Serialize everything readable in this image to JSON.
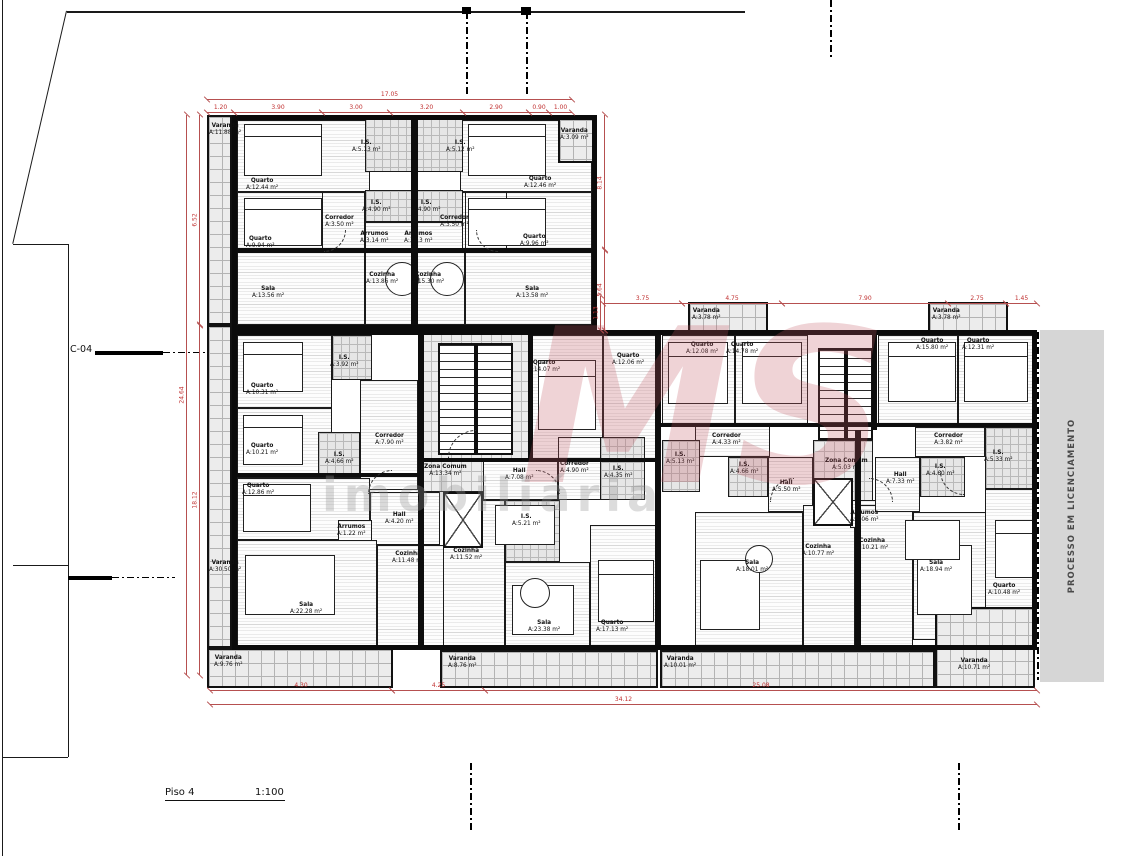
{
  "title": {
    "floor_label": "Piso 4",
    "scale_label": "1:100"
  },
  "side_note": {
    "text": "PROCESSO EM LICENCIAMENTO"
  },
  "section_marker": {
    "label": "C-04"
  },
  "watermark": {
    "logo": "MS",
    "word": "imobiliária"
  },
  "colors": {
    "dimension_line": "#b65050",
    "dimension_text": "#c03030",
    "wall": "#0d0d0d",
    "balcony_bg": "#ececec",
    "band_bg": "#d6d6d6",
    "watermark_logo": "rgba(193,85,95,0.26)"
  },
  "outlines": [
    {
      "x": 232,
      "y": 115,
      "w": 365,
      "h": 215
    },
    {
      "x": 232,
      "y": 330,
      "w": 805,
      "h": 320
    }
  ],
  "rooms": [
    {
      "n": "Varanda",
      "a": "A:11.88 m²",
      "x": 207,
      "y": 115,
      "w": 25,
      "h": 210,
      "t": "balcony",
      "lx": 209,
      "ly": 123
    },
    {
      "n": "Varanda",
      "a": "A:30.50 m²",
      "x": 207,
      "y": 325,
      "w": 25,
      "h": 323,
      "t": "balcony",
      "lx": 209,
      "ly": 560
    },
    {
      "n": "Varanda",
      "a": "A:9.76 m²",
      "x": 207,
      "y": 648,
      "w": 186,
      "h": 40,
      "t": "balcony",
      "lx": 214,
      "ly": 655
    },
    {
      "n": "Quarto",
      "a": "A:12.44 m²",
      "x": 237,
      "y": 120,
      "w": 133,
      "h": 72,
      "t": "room",
      "lx": 246,
      "ly": 178
    },
    {
      "n": "Quarto",
      "a": "A:9.94 m²",
      "x": 237,
      "y": 192,
      "w": 133,
      "h": 60,
      "t": "room",
      "lx": 246,
      "ly": 236
    },
    {
      "n": "Sala",
      "a": "A:13.56 m²",
      "x": 237,
      "y": 252,
      "w": 128,
      "h": 73,
      "t": "room",
      "lx": 252,
      "ly": 286
    },
    {
      "n": "Cozinha",
      "a": "A:13.86 m²",
      "x": 365,
      "y": 252,
      "w": 49,
      "h": 73,
      "t": "room",
      "lx": 366,
      "ly": 272
    },
    {
      "n": "I.S.",
      "a": "A:5.13 m²",
      "x": 365,
      "y": 118,
      "w": 49,
      "h": 54,
      "t": "bath",
      "lx": 352,
      "ly": 140
    },
    {
      "n": "I.S.",
      "a": "A:4.90 m²",
      "x": 365,
      "y": 190,
      "w": 49,
      "h": 32,
      "t": "bath",
      "lx": 362,
      "ly": 200
    },
    {
      "n": "Arrumos",
      "a": "A:3.14 m²",
      "x": 365,
      "y": 222,
      "w": 49,
      "h": 30,
      "t": "room",
      "lx": 360,
      "ly": 231
    },
    {
      "n": "Corredor",
      "a": "A:3.50 m²",
      "x": 322,
      "y": 192,
      "w": 43,
      "h": 60,
      "t": "room",
      "lx": 325,
      "ly": 215
    },
    {
      "n": "Quarto",
      "a": "A:12.46 m²",
      "x": 460,
      "y": 120,
      "w": 132,
      "h": 72,
      "t": "room",
      "lx": 524,
      "ly": 176
    },
    {
      "n": "Quarto",
      "a": "A:9.96 m²",
      "x": 460,
      "y": 192,
      "w": 132,
      "h": 60,
      "t": "room",
      "lx": 520,
      "ly": 234
    },
    {
      "n": "Sala",
      "a": "A:13.58 m²",
      "x": 465,
      "y": 252,
      "w": 127,
      "h": 73,
      "t": "room",
      "lx": 516,
      "ly": 286
    },
    {
      "n": "Cozinha",
      "a": "A:15.30 m²",
      "x": 414,
      "y": 252,
      "w": 51,
      "h": 73,
      "t": "room",
      "lx": 412,
      "ly": 272
    },
    {
      "n": "I.S.",
      "a": "A:5.12 m²",
      "x": 414,
      "y": 118,
      "w": 49,
      "h": 54,
      "t": "bath",
      "lx": 446,
      "ly": 140
    },
    {
      "n": "I.S.",
      "a": "A:4.90 m²",
      "x": 414,
      "y": 190,
      "w": 49,
      "h": 32,
      "t": "bath",
      "lx": 412,
      "ly": 200
    },
    {
      "n": "Arrumos",
      "a": "A:3.13 m²",
      "x": 414,
      "y": 222,
      "w": 49,
      "h": 30,
      "t": "room",
      "lx": 404,
      "ly": 231
    },
    {
      "n": "Corredor",
      "a": "A:3.50 m²",
      "x": 465,
      "y": 192,
      "w": 42,
      "h": 60,
      "t": "room",
      "lx": 440,
      "ly": 215
    },
    {
      "n": "Varanda",
      "a": "A:3.09 m²",
      "x": 558,
      "y": 118,
      "w": 37,
      "h": 45,
      "t": "balcony",
      "lx": 560,
      "ly": 128
    },
    {
      "n": "Quarto",
      "a": "A:10.31 m²",
      "x": 237,
      "y": 335,
      "w": 95,
      "h": 73,
      "t": "room",
      "lx": 246,
      "ly": 383
    },
    {
      "n": "Quarto",
      "a": "A:10.21 m²",
      "x": 237,
      "y": 408,
      "w": 95,
      "h": 70,
      "t": "room",
      "lx": 246,
      "ly": 443
    },
    {
      "n": "I.S.",
      "a": "A:3.92 m²",
      "x": 332,
      "y": 335,
      "w": 40,
      "h": 45,
      "t": "bath",
      "lx": 330,
      "ly": 355
    },
    {
      "n": "I.S.",
      "a": "A:4.66 m²",
      "x": 318,
      "y": 432,
      "w": 42,
      "h": 46,
      "t": "bath",
      "lx": 325,
      "ly": 452
    },
    {
      "n": "Corredor",
      "a": "A:7.90 m²",
      "x": 360,
      "y": 380,
      "w": 58,
      "h": 110,
      "t": "room",
      "lx": 375,
      "ly": 433
    },
    {
      "n": "Quarto",
      "a": "A:12.86 m²",
      "x": 237,
      "y": 478,
      "w": 133,
      "h": 62,
      "t": "room",
      "lx": 242,
      "ly": 483
    },
    {
      "n": "Hall",
      "a": "A:4.20 m²",
      "x": 370,
      "y": 492,
      "w": 70,
      "h": 53,
      "t": "room",
      "lx": 385,
      "ly": 512
    },
    {
      "n": "Arrumos",
      "a": "A:1.22 m²",
      "x": 338,
      "y": 520,
      "w": 34,
      "h": 25,
      "t": "room",
      "lx": 337,
      "ly": 524
    },
    {
      "n": "Sala",
      "a": "A:22.28 m²",
      "x": 237,
      "y": 540,
      "w": 140,
      "h": 110,
      "t": "room",
      "lx": 290,
      "ly": 602
    },
    {
      "n": "Cozinha",
      "a": "A:11.48 m²",
      "x": 377,
      "y": 545,
      "w": 68,
      "h": 105,
      "t": "room",
      "lx": 392,
      "ly": 551
    },
    {
      "n": "Zona Comum",
      "a": "A:13.34 m²",
      "x": 420,
      "y": 330,
      "w": 110,
      "h": 162,
      "t": "core",
      "lx": 424,
      "ly": 464
    },
    {
      "n": "Quarto",
      "a": "A:14.07 m²",
      "x": 530,
      "y": 335,
      "w": 73,
      "h": 125,
      "t": "room",
      "lx": 528,
      "ly": 360
    },
    {
      "n": "Quarto",
      "a": "A:12.06 m²",
      "x": 603,
      "y": 335,
      "w": 55,
      "h": 125,
      "t": "room",
      "lx": 612,
      "ly": 353
    },
    {
      "n": "Hall",
      "a": "A:7.08 m²",
      "x": 483,
      "y": 460,
      "w": 75,
      "h": 40,
      "t": "room",
      "lx": 505,
      "ly": 468
    },
    {
      "n": "Corredor",
      "a": "A:4.90 m²",
      "x": 558,
      "y": 437,
      "w": 45,
      "h": 63,
      "t": "room",
      "lx": 560,
      "ly": 461
    },
    {
      "n": "I.S.",
      "a": "A:4.35 m²",
      "x": 600,
      "y": 437,
      "w": 45,
      "h": 63,
      "t": "bath",
      "lx": 604,
      "ly": 466
    },
    {
      "n": "I.S.",
      "a": "A:5.21 m²",
      "x": 505,
      "y": 500,
      "w": 55,
      "h": 62,
      "t": "bath",
      "lx": 512,
      "ly": 514
    },
    {
      "n": "Cozinha",
      "a": "A:11.52 m²",
      "x": 443,
      "y": 500,
      "w": 62,
      "h": 150,
      "t": "room",
      "lx": 450,
      "ly": 548
    },
    {
      "n": "Sala",
      "a": "A:23.38 m²",
      "x": 505,
      "y": 562,
      "w": 85,
      "h": 88,
      "t": "room",
      "lx": 528,
      "ly": 620
    },
    {
      "n": "Quarto",
      "a": "A:17.13 m²",
      "x": 590,
      "y": 525,
      "w": 68,
      "h": 125,
      "t": "room",
      "lx": 596,
      "ly": 620
    },
    {
      "n": "Quarto",
      "a": "A:12.08 m²",
      "x": 662,
      "y": 335,
      "w": 73,
      "h": 90,
      "t": "room",
      "lx": 686,
      "ly": 342
    },
    {
      "n": "Quarto",
      "a": "A:14.78 m²",
      "x": 735,
      "y": 335,
      "w": 73,
      "h": 90,
      "t": "room",
      "lx": 726,
      "ly": 342
    },
    {
      "n": "Corredor",
      "a": "A:4.33 m²",
      "x": 695,
      "y": 425,
      "w": 75,
      "h": 32,
      "t": "room",
      "lx": 712,
      "ly": 433
    },
    {
      "n": "I.S.",
      "a": "A:5.13 m²",
      "x": 662,
      "y": 440,
      "w": 38,
      "h": 52,
      "t": "bath",
      "lx": 666,
      "ly": 452
    },
    {
      "n": "I.S.",
      "a": "A:4.66 m²",
      "x": 728,
      "y": 457,
      "w": 40,
      "h": 40,
      "t": "bath",
      "lx": 730,
      "ly": 462
    },
    {
      "n": "Hall",
      "a": "A:5.50 m²",
      "x": 768,
      "y": 457,
      "w": 45,
      "h": 55,
      "t": "room",
      "lx": 772,
      "ly": 480
    },
    {
      "n": "Sala",
      "a": "A:18.01 m²",
      "x": 695,
      "y": 512,
      "w": 108,
      "h": 138,
      "t": "room",
      "lx": 736,
      "ly": 560
    },
    {
      "n": "Cozinha",
      "a": "A:10.77 m²",
      "x": 803,
      "y": 505,
      "w": 52,
      "h": 145,
      "t": "room",
      "lx": 802,
      "ly": 544
    },
    {
      "n": "Zona Comum",
      "a": "A:5.03 m²",
      "x": 813,
      "y": 440,
      "w": 60,
      "h": 65,
      "t": "core",
      "lx": 825,
      "ly": 458
    },
    {
      "n": "Arrumos",
      "a": "A:1.06 m²",
      "x": 850,
      "y": 500,
      "w": 32,
      "h": 28,
      "t": "room",
      "lx": 850,
      "ly": 510
    },
    {
      "n": "Cozinha",
      "a": "A:10.21 m²",
      "x": 858,
      "y": 505,
      "w": 55,
      "h": 145,
      "t": "room",
      "lx": 856,
      "ly": 538
    },
    {
      "n": "Quarto",
      "a": "A:15.80 m²",
      "x": 878,
      "y": 335,
      "w": 80,
      "h": 92,
      "t": "room",
      "lx": 916,
      "ly": 338
    },
    {
      "n": "Quarto",
      "a": "A:12.31 m²",
      "x": 958,
      "y": 335,
      "w": 77,
      "h": 92,
      "t": "room",
      "lx": 962,
      "ly": 338
    },
    {
      "n": "Corredor",
      "a": "A:3.82 m²",
      "x": 915,
      "y": 427,
      "w": 70,
      "h": 30,
      "t": "room",
      "lx": 934,
      "ly": 433
    },
    {
      "n": "I.S.",
      "a": "A:5.33 m²",
      "x": 985,
      "y": 427,
      "w": 50,
      "h": 62,
      "t": "bath",
      "lx": 984,
      "ly": 450
    },
    {
      "n": "I.S.",
      "a": "A:4.60 m²",
      "x": 920,
      "y": 457,
      "w": 45,
      "h": 40,
      "t": "bath",
      "lx": 926,
      "ly": 464
    },
    {
      "n": "Hall",
      "a": "A:7.33 m²",
      "x": 875,
      "y": 457,
      "w": 45,
      "h": 55,
      "t": "room",
      "lx": 886,
      "ly": 472
    },
    {
      "n": "Sala",
      "a": "A:18.94 m²",
      "x": 913,
      "y": 512,
      "w": 92,
      "h": 128,
      "t": "room",
      "lx": 920,
      "ly": 560
    },
    {
      "n": "Quarto",
      "a": "A:10.48 m²",
      "x": 985,
      "y": 489,
      "w": 50,
      "h": 125,
      "t": "room",
      "lx": 988,
      "ly": 583
    },
    {
      "n": "Varanda",
      "a": "A:3.78 m²",
      "x": 688,
      "y": 302,
      "w": 80,
      "h": 32,
      "t": "balcony",
      "lx": 692,
      "ly": 308
    },
    {
      "n": "Varanda",
      "a": "A:3.78 m²",
      "x": 928,
      "y": 302,
      "w": 80,
      "h": 32,
      "t": "balcony",
      "lx": 932,
      "ly": 308
    },
    {
      "n": "Varanda",
      "a": "A:8.76 m²",
      "x": 440,
      "y": 650,
      "w": 218,
      "h": 38,
      "t": "balcony",
      "lx": 448,
      "ly": 656
    },
    {
      "n": "Varanda",
      "a": "A:10.01 m²",
      "x": 660,
      "y": 650,
      "w": 275,
      "h": 38,
      "t": "balcony",
      "lx": 664,
      "ly": 656
    },
    {
      "n": "Varanda",
      "a": "A:10.71 m²",
      "x": 935,
      "y": 607,
      "w": 100,
      "h": 81,
      "t": "balcony",
      "lx": 958,
      "ly": 658
    }
  ],
  "walls": [
    {
      "x": 411,
      "y": 115,
      "w": 7,
      "h": 215
    },
    {
      "x": 418,
      "y": 330,
      "w": 6,
      "h": 320
    },
    {
      "x": 655,
      "y": 330,
      "w": 6,
      "h": 320
    },
    {
      "x": 855,
      "y": 430,
      "w": 6,
      "h": 220
    },
    {
      "x": 528,
      "y": 330,
      "w": 5,
      "h": 132
    },
    {
      "x": 232,
      "y": 248,
      "w": 365,
      "h": 5
    },
    {
      "x": 232,
      "y": 473,
      "w": 190,
      "h": 4
    },
    {
      "x": 660,
      "y": 423,
      "w": 377,
      "h": 4
    },
    {
      "x": 872,
      "y": 330,
      "w": 5,
      "h": 100
    },
    {
      "x": 424,
      "y": 458,
      "w": 235,
      "h": 4
    }
  ],
  "stairs": [
    {
      "x": 438,
      "y": 343,
      "w": 75,
      "h": 112
    },
    {
      "x": 818,
      "y": 348,
      "w": 55,
      "h": 92
    }
  ],
  "lifts": [
    {
      "x": 443,
      "y": 492,
      "w": 40,
      "h": 56
    },
    {
      "x": 813,
      "y": 478,
      "w": 40,
      "h": 48
    }
  ],
  "beds": [
    {
      "x": 244,
      "y": 124,
      "w": 78,
      "h": 52
    },
    {
      "x": 244,
      "y": 198,
      "w": 78,
      "h": 48
    },
    {
      "x": 468,
      "y": 124,
      "w": 78,
      "h": 52
    },
    {
      "x": 468,
      "y": 198,
      "w": 78,
      "h": 48
    },
    {
      "x": 243,
      "y": 342,
      "w": 60,
      "h": 50
    },
    {
      "x": 243,
      "y": 415,
      "w": 60,
      "h": 50
    },
    {
      "x": 243,
      "y": 484,
      "w": 68,
      "h": 48
    },
    {
      "x": 538,
      "y": 360,
      "w": 58,
      "h": 70
    },
    {
      "x": 668,
      "y": 342,
      "w": 60,
      "h": 62
    },
    {
      "x": 742,
      "y": 342,
      "w": 60,
      "h": 62
    },
    {
      "x": 888,
      "y": 342,
      "w": 68,
      "h": 60
    },
    {
      "x": 964,
      "y": 342,
      "w": 64,
      "h": 60
    },
    {
      "x": 598,
      "y": 560,
      "w": 56,
      "h": 62
    },
    {
      "x": 995,
      "y": 520,
      "w": 38,
      "h": 58
    }
  ],
  "sofas": [
    {
      "x": 245,
      "y": 555,
      "w": 90,
      "h": 60
    },
    {
      "x": 512,
      "y": 585,
      "w": 62,
      "h": 50
    },
    {
      "x": 700,
      "y": 560,
      "w": 60,
      "h": 70
    },
    {
      "x": 917,
      "y": 545,
      "w": 55,
      "h": 70
    }
  ],
  "rtables": [
    {
      "x": 495,
      "y": 505,
      "w": 60,
      "h": 40
    },
    {
      "x": 905,
      "y": 520,
      "w": 55,
      "h": 40
    }
  ],
  "ctables": [
    {
      "x": 385,
      "y": 262,
      "d": 34
    },
    {
      "x": 430,
      "y": 262,
      "d": 34
    },
    {
      "x": 520,
      "y": 578,
      "d": 30
    },
    {
      "x": 745,
      "y": 545,
      "d": 28
    }
  ],
  "doors": [
    {
      "x": 448,
      "y": 430,
      "s": 28,
      "rot": 0
    },
    {
      "x": 560,
      "y": 470,
      "s": 24,
      "rot": 90
    },
    {
      "x": 770,
      "y": 478,
      "s": 24,
      "rot": 0
    },
    {
      "x": 893,
      "y": 478,
      "s": 24,
      "rot": 90
    },
    {
      "x": 346,
      "y": 252,
      "s": 22,
      "rot": 180
    },
    {
      "x": 476,
      "y": 252,
      "s": 22,
      "rot": 270
    },
    {
      "x": 368,
      "y": 470,
      "s": 24,
      "rot": 0
    },
    {
      "x": 940,
      "y": 495,
      "s": 24,
      "rot": 270
    }
  ],
  "dimensions_h": [
    {
      "x": 207,
      "y": 99,
      "len": 365,
      "label": "17.05"
    },
    {
      "x": 207,
      "y": 112,
      "len": 27,
      "label": "1.20"
    },
    {
      "x": 234,
      "y": 112,
      "len": 88,
      "label": "3.90"
    },
    {
      "x": 322,
      "y": 112,
      "len": 68,
      "label": "3.00"
    },
    {
      "x": 390,
      "y": 112,
      "len": 73,
      "label": "3.20"
    },
    {
      "x": 463,
      "y": 112,
      "len": 66,
      "label": "2.90"
    },
    {
      "x": 529,
      "y": 112,
      "len": 20,
      "label": "0.90"
    },
    {
      "x": 549,
      "y": 112,
      "len": 23,
      "label": "1.00"
    },
    {
      "x": 603,
      "y": 303,
      "len": 79,
      "label": "3.75"
    },
    {
      "x": 682,
      "y": 303,
      "len": 100,
      "label": "4.75"
    },
    {
      "x": 782,
      "y": 303,
      "len": 166,
      "label": "7.90"
    },
    {
      "x": 948,
      "y": 303,
      "len": 58,
      "label": "2.75"
    },
    {
      "x": 1006,
      "y": 303,
      "len": 31,
      "label": "1.45"
    },
    {
      "x": 210,
      "y": 690,
      "len": 182,
      "label": "4.30"
    },
    {
      "x": 392,
      "y": 690,
      "len": 93,
      "label": "4.25"
    },
    {
      "x": 485,
      "y": 690,
      "len": 552,
      "label": "25.08"
    },
    {
      "x": 210,
      "y": 704,
      "len": 827,
      "label": "34.12"
    }
  ],
  "dimensions_v": [
    {
      "x": 186,
      "y": 115,
      "len": 560,
      "label": "24.64"
    },
    {
      "x": 199,
      "y": 115,
      "len": 210,
      "label": "6.52"
    },
    {
      "x": 199,
      "y": 325,
      "len": 350,
      "label": "18.12"
    },
    {
      "x": 604,
      "y": 115,
      "len": 135,
      "label": "8.14"
    },
    {
      "x": 604,
      "y": 250,
      "len": 80,
      "label": "5.64"
    },
    {
      "x": 600,
      "y": 296,
      "len": 34,
      "label": "1.13"
    }
  ],
  "site_lines": [
    {
      "x": 2,
      "y": 0,
      "w": 1,
      "h": 856
    },
    {
      "x": 67,
      "y": 11,
      "w": 678,
      "h": 1.5
    },
    {
      "x": 67,
      "y": 11,
      "w": 239,
      "h": 1,
      "rot": 103
    },
    {
      "x": 13,
      "y": 244,
      "w": 55,
      "h": 1
    },
    {
      "x": 68,
      "y": 244,
      "w": 1,
      "h": 513
    },
    {
      "x": 13,
      "y": 565,
      "w": 55,
      "h": 1
    },
    {
      "x": 2,
      "y": 757,
      "w": 66,
      "h": 1
    }
  ],
  "dash_lines_v": [
    {
      "x": 466,
      "y": 12,
      "h": 83
    },
    {
      "x": 526,
      "y": 12,
      "h": 83
    },
    {
      "x": 830,
      "y": 0,
      "h": 58
    },
    {
      "x": 470,
      "y": 763,
      "h": 70
    },
    {
      "x": 958,
      "y": 763,
      "h": 70
    },
    {
      "x": 1037,
      "y": 332,
      "h": 348
    }
  ],
  "caps": [
    {
      "x": 462,
      "y": 7,
      "w": 9,
      "h": 7
    },
    {
      "x": 521,
      "y": 7,
      "w": 10,
      "h": 8
    }
  ],
  "section_lines": [
    {
      "thick": {
        "x": 95,
        "y": 351,
        "w": 68,
        "h": 4
      },
      "dash": {
        "x": 163,
        "y": 352,
        "w": 47
      }
    },
    {
      "thick": {
        "x": 68,
        "y": 576,
        "w": 44,
        "h": 4
      },
      "dash": {
        "x": 112,
        "y": 577,
        "w": 63
      }
    }
  ]
}
